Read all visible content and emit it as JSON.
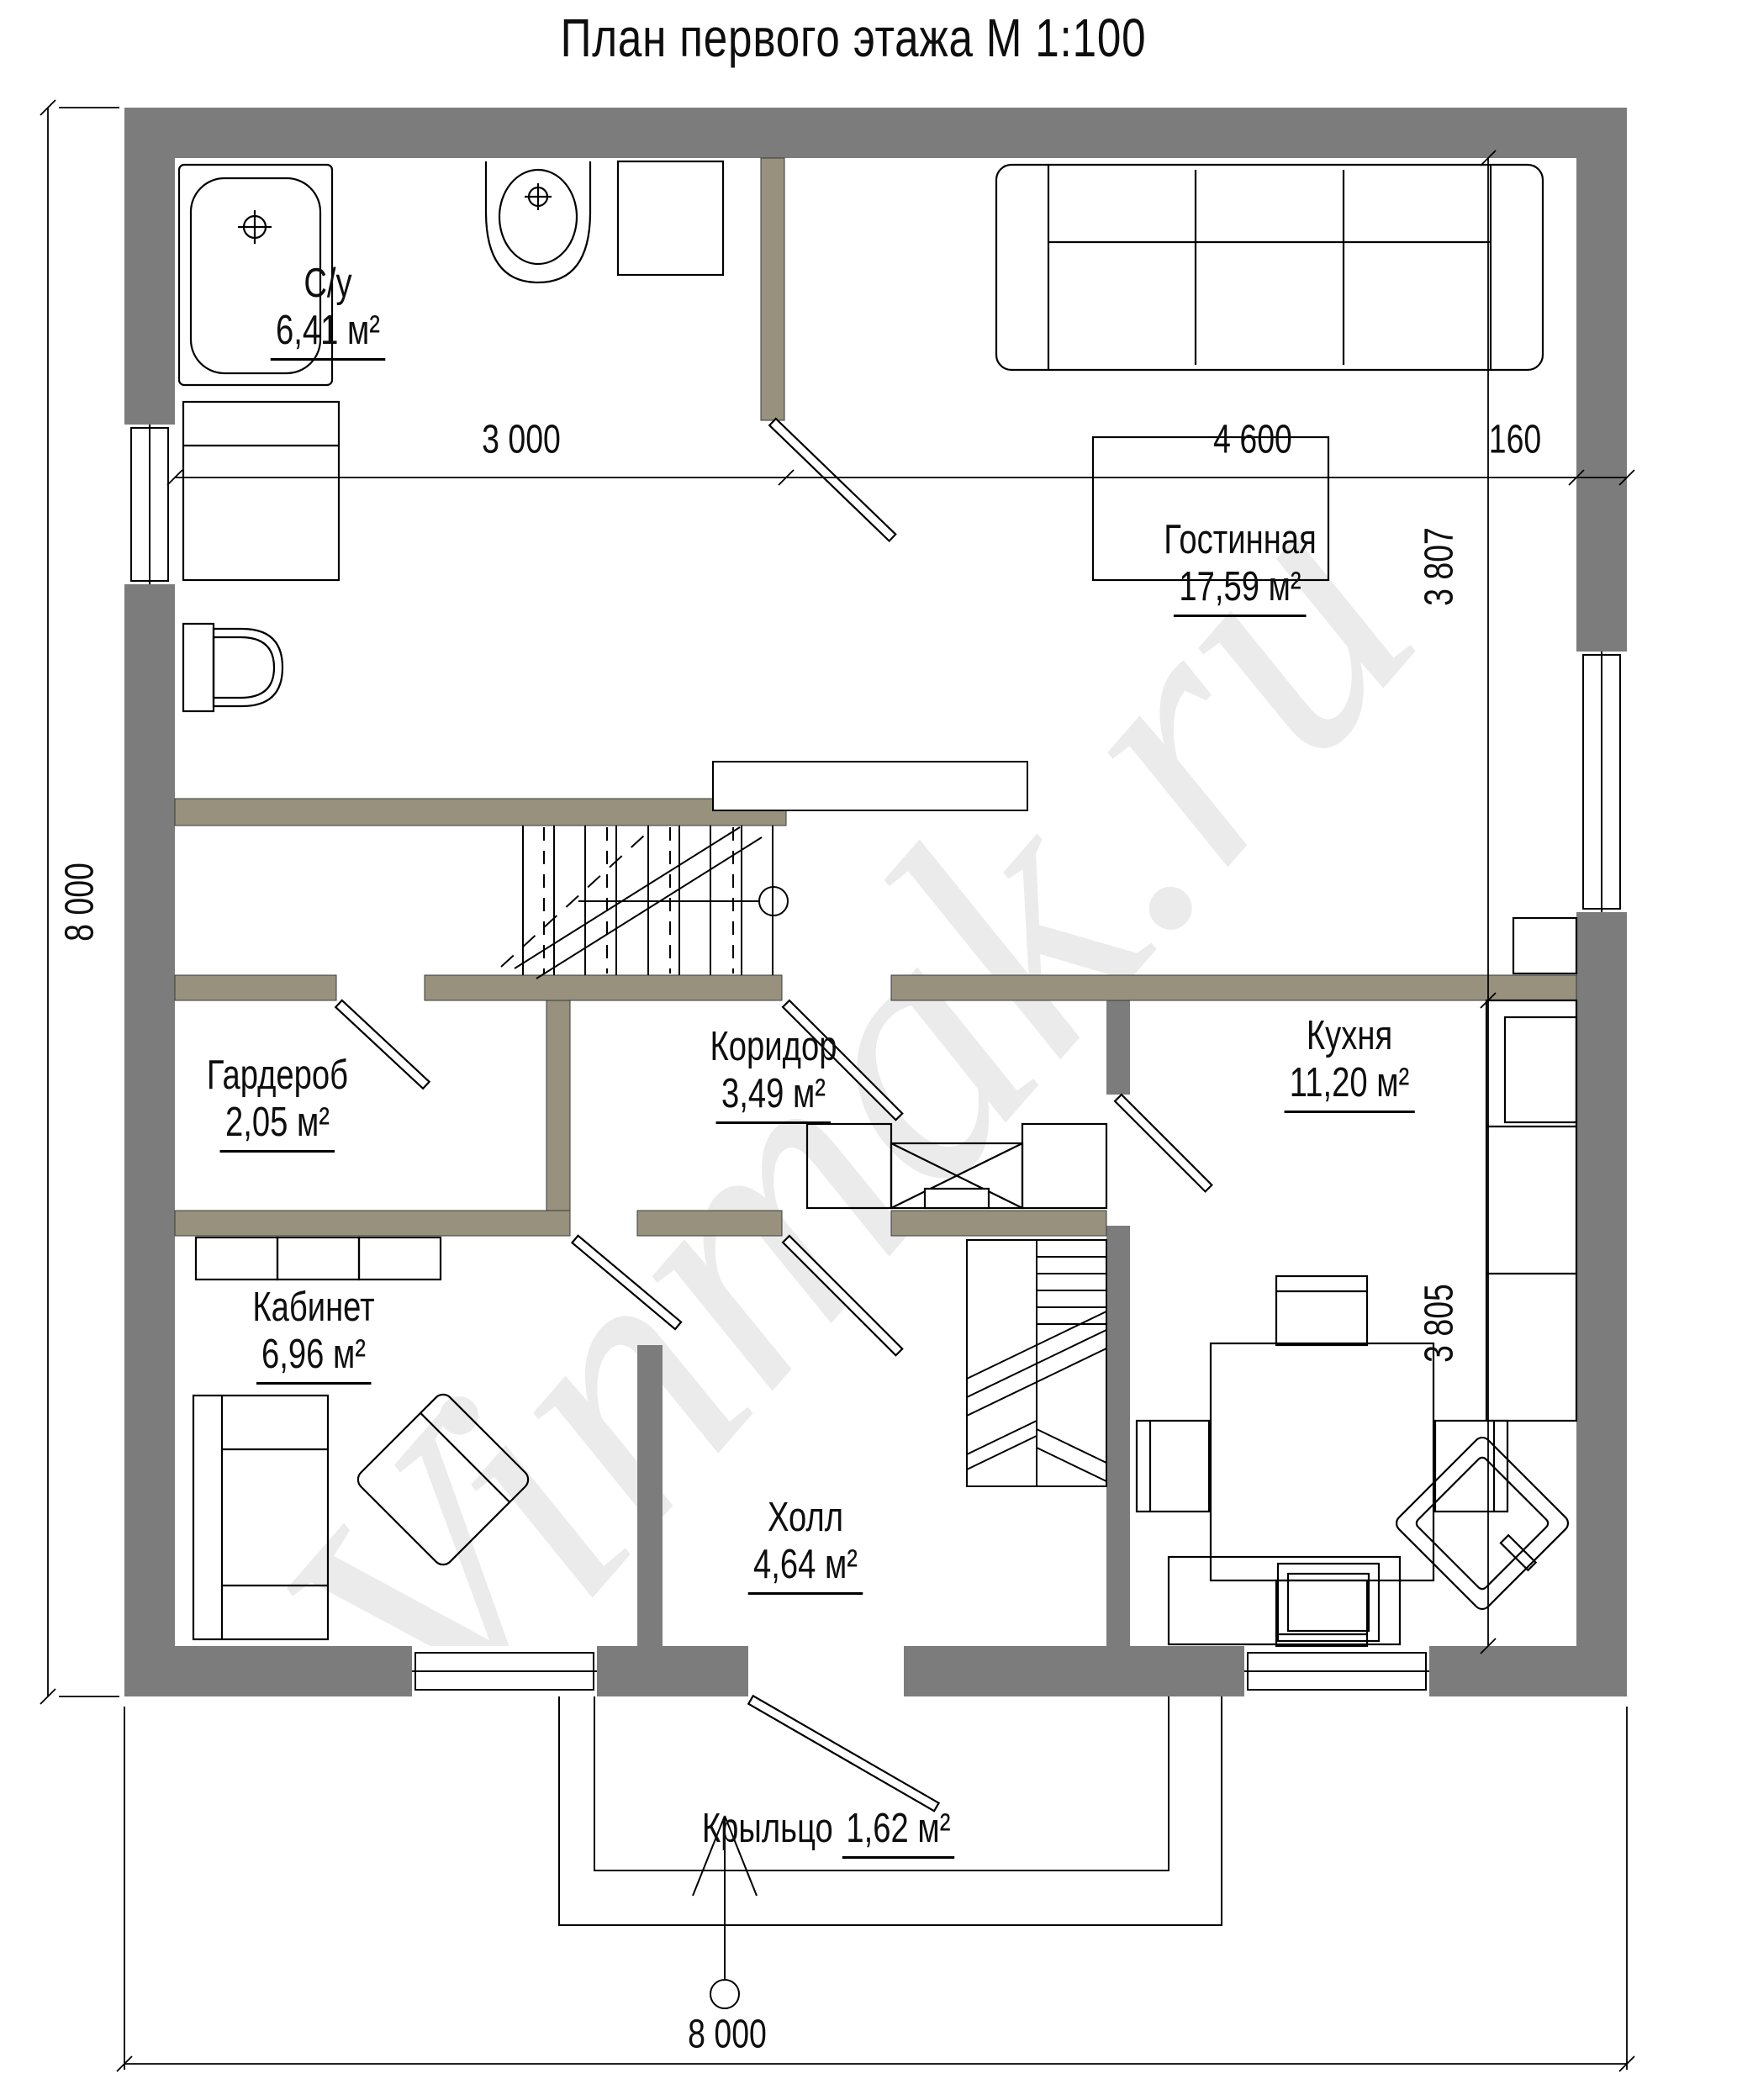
{
  "title": "План первого этажа М 1:100",
  "watermark": "Vinmak.ru",
  "rooms": [
    {
      "name": "С/у",
      "area": "6,41 м²"
    },
    {
      "name": "Гостинная",
      "area": "17,59 м²"
    },
    {
      "name": "Гардероб",
      "area": "2,05 м²"
    },
    {
      "name": "Коридор",
      "area": "3,49 м²"
    },
    {
      "name": "Кухня",
      "area": "11,20 м²"
    },
    {
      "name": "Кабинет",
      "area": "6,96 м²"
    },
    {
      "name": "Холл",
      "area": "4,64 м²"
    },
    {
      "name": "Крыльцо",
      "area": "1,62 м²"
    }
  ],
  "dimensions": {
    "top_left": "3 000",
    "top_right": "4 600",
    "top_wall": "160",
    "right_upper": "3 807",
    "right_lower": "3 805",
    "left_total": "8 000",
    "bottom_total": "8 000"
  },
  "colors": {
    "exterior_wall": "#7C7C7C",
    "interior_wall": "#97917E",
    "line": "#000000",
    "watermark": "#EBEBEB"
  }
}
